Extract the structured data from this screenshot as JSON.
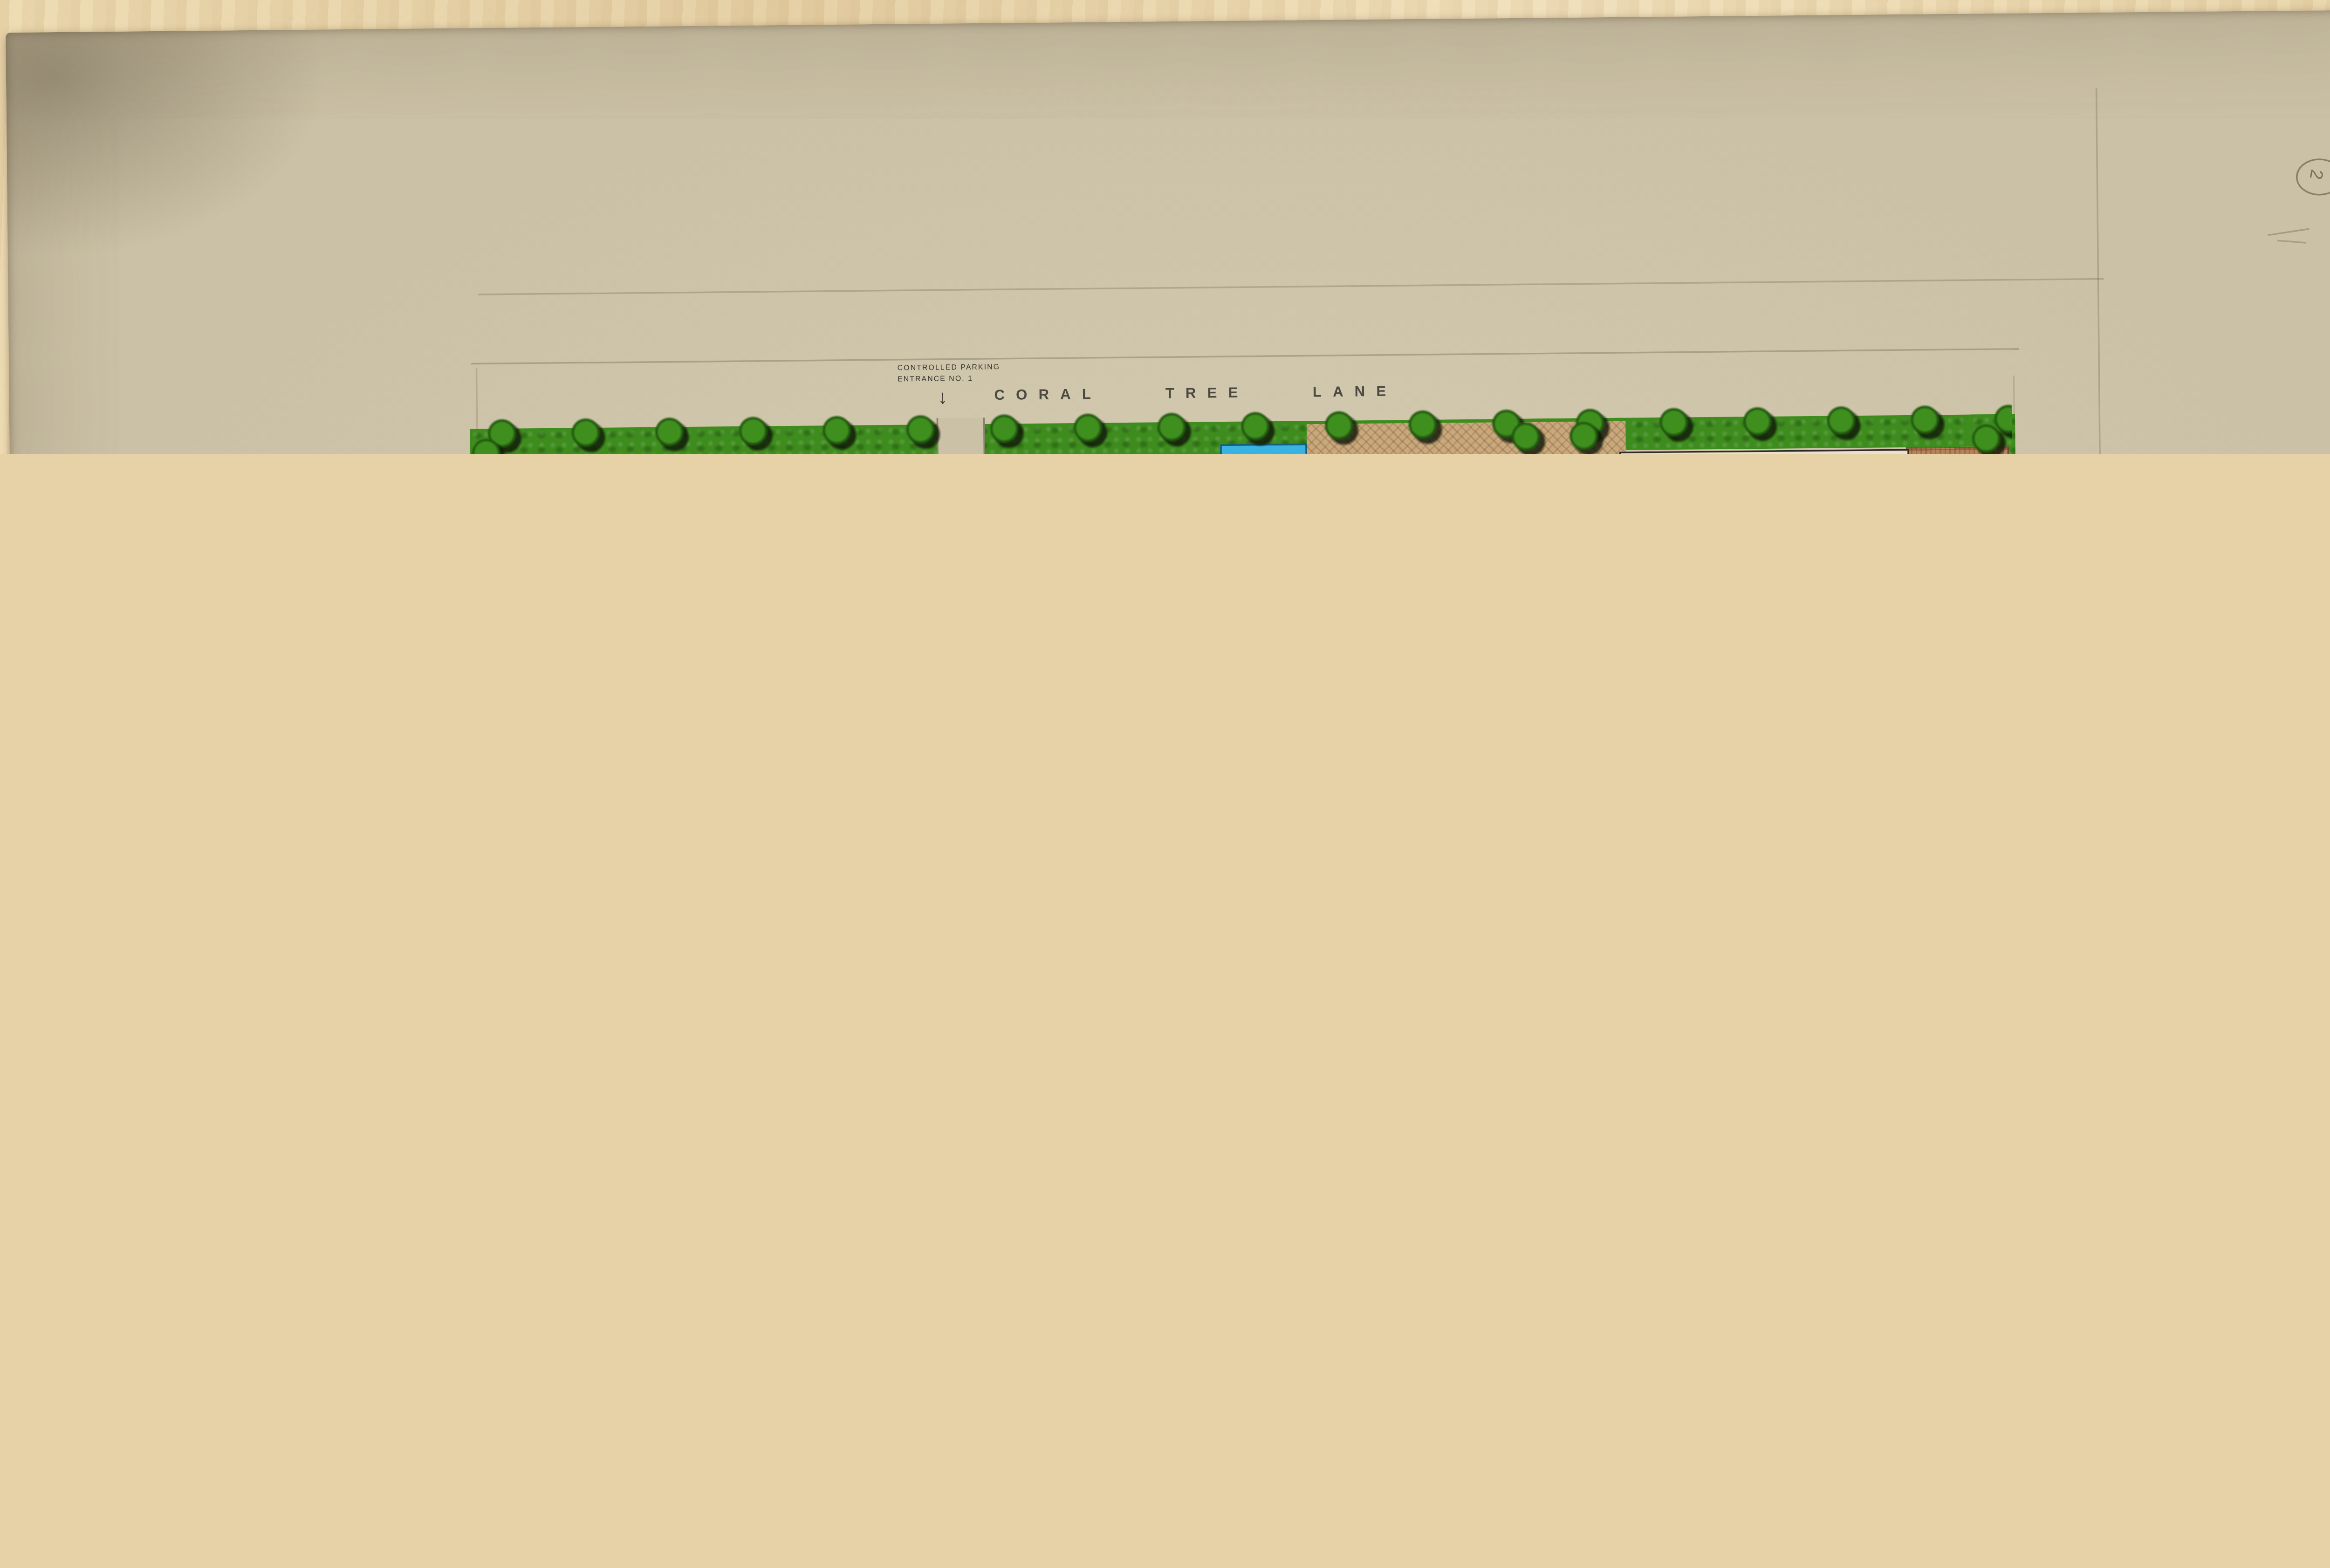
{
  "streets": {
    "north": "CORAL TREE LANE",
    "south": "JEFFERSON BOULEVARD",
    "west": "ALLA ROAD",
    "east": "BEETHOVEN STREET"
  },
  "entrances": {
    "no1": "CONTROLLED PARKING\nENTRANCE NO. 1",
    "no1_arrow": "\u2193",
    "no2": "CONTROLLED\nPARKING\nENTRANCE\nNO. 2",
    "no2_arrow": "\u2192",
    "no2_dimension": "60'-0"
  },
  "buildings": {
    "electronics_a": "ELECTRONICS\nBLDG. A",
    "bld_b_west": "BLD. B",
    "headquarters": "HEADQUARTERS\nBLDG.",
    "engineering_a": "ENGINEERING\nBLDG. A",
    "bldg_b_east": "BLDG. B",
    "engineering_c": "ENGINEERING BLDG. C",
    "processing": "PROCESSING",
    "testing": "TESTING"
  },
  "site_labels": {
    "controlled_parking": "CONTROLLED PARKING 312 SPACES",
    "guest_west": "GUEST\nPARKING\n12  SPACES",
    "guest_plaza": "GUEST\nPARKING\n26  SPACES",
    "guest_northeast": "GUEST\nPARKING\n8  SPACES",
    "guest_southeast": "GUEST\nPARKING\n6  SPACES",
    "transformer": "TRANSFORMER",
    "trash_west": "TRASH",
    "trash_east": "TRASH",
    "gas": "GAS"
  },
  "parking_summary": {
    "rows": [
      {
        "label": "TOTAL COMPLEX GUEST PARKING",
        "value": "52",
        "unit": "SPACES"
      },
      {
        "label": "TOTAL COMPLEX CONTROLLED PARKING",
        "value": "312",
        "unit": "SPACES"
      },
      {
        "label": "TOTAL COMPLEX PARKING",
        "value": "364",
        "unit": "SPACES"
      }
    ]
  },
  "title_block": {
    "project": "McCULLOCH HEADQUARTERS",
    "drawing": "PLOT PLAN",
    "firm": "WILLIAM F. CODY AND ASSOCIATES INC.",
    "service_left": "ARCHITECTURE",
    "service_right": "LAND PLANNING",
    "address": "550 SOUTH PALM CANYON DRIVE    PALM SPRINGS, CALIFORNIA 92262"
  },
  "annotations": {
    "sheet_number": "2",
    "pencil_note": "85-1\n24"
  },
  "colors": {
    "paper": "#cbc1a6",
    "ink": "#35342c",
    "title_ink": "#3b3b52",
    "lawn_green": "#3e8c1e",
    "pool_blue": "#2ea5d8",
    "brick": "#b5835a",
    "plaza_tan": "#c9a87c",
    "building_cream": "#e9e1ca",
    "wood_desk": "#e6d2a6"
  }
}
